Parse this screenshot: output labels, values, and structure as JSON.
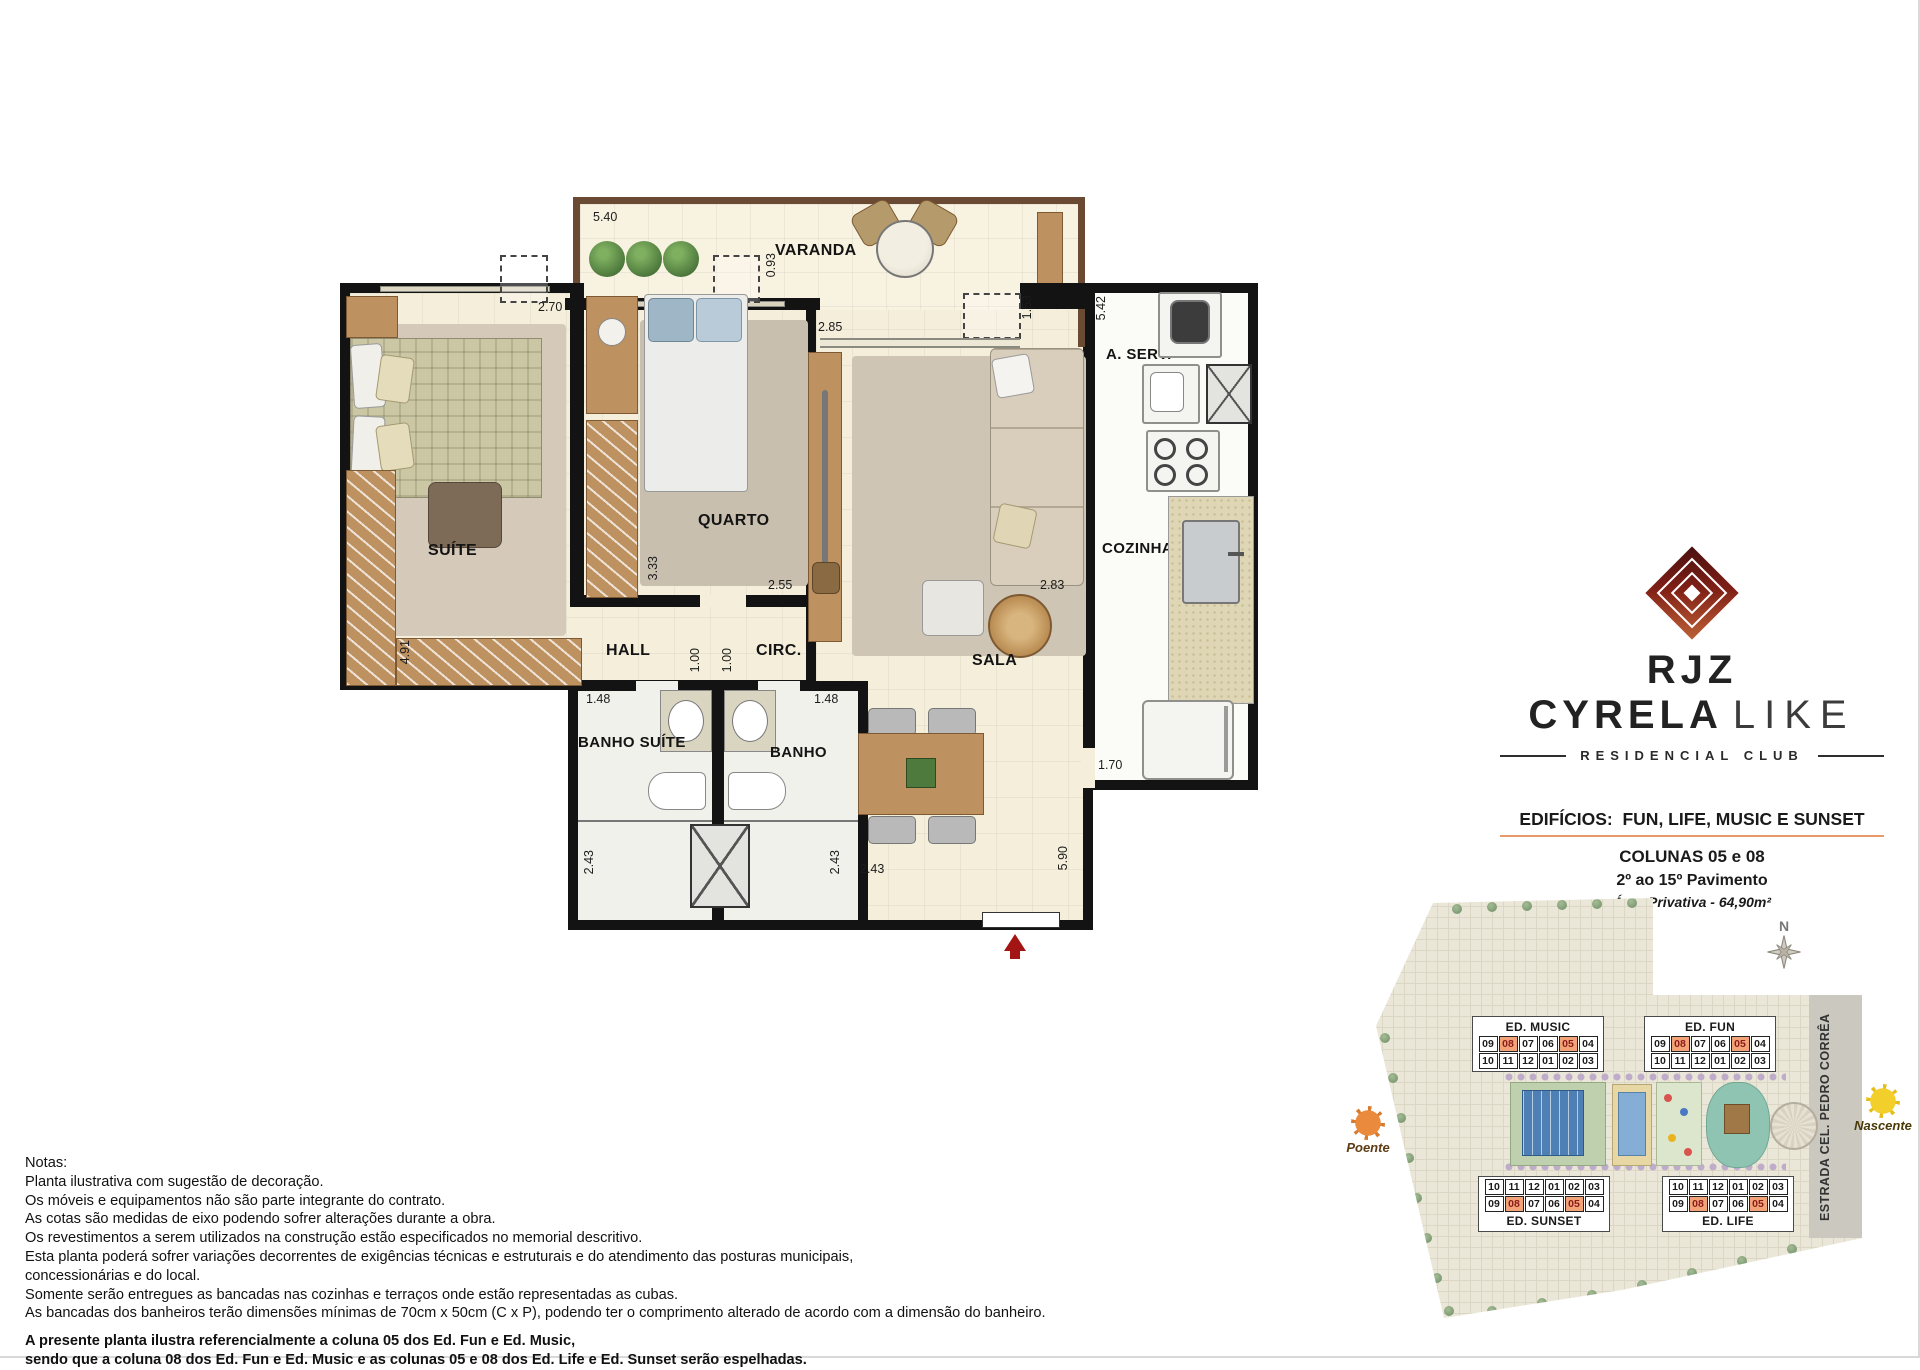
{
  "floorplan": {
    "rooms": {
      "varanda": "VARANDA",
      "suite": "SUÍTE",
      "quarto": "QUARTO",
      "sala": "SALA",
      "cozinha": "COZINHA",
      "area_servico": "A. SERV.",
      "hall": "HALL",
      "circ": "CIRC.",
      "banho_suite": "BANHO SUÍTE",
      "banho": "BANHO"
    },
    "dims": {
      "varanda_width": "5.40",
      "ac_quarto": "0.93",
      "sala_window": "2.85",
      "ac_sala": "1.53",
      "servico_length": "5.42",
      "suite_width": "2.70",
      "quarto_depth": "3.33",
      "quarto_width": "2.55",
      "sala_width": "2.83",
      "banho_suite_width": "1.48",
      "banho_width": "1.48",
      "hall_width": "1.00",
      "circ_width": "1.00",
      "suite_depth": "4.91",
      "banho_suite_depth": "2.43",
      "banho_depth": "2.43",
      "dining_width": "2.43",
      "cozinha_width": "1.70",
      "sala_depth": "5.90"
    }
  },
  "branding": {
    "logo_primary": "RJZ CYRELA",
    "logo_secondary": "LIKE",
    "tagline": "RESIDENCIAL CLUB"
  },
  "info": {
    "edificios": "EDIFÍCIOS:  FUN, LIFE, MUSIC E SUNSET",
    "colunas": "COLUNAS 05 e 08",
    "pavimento": "2º ao 15º Pavimento",
    "area": "Área Privativa - 64,90m²"
  },
  "siteplan": {
    "compass": "N",
    "road": "ESTRADA CEL. PEDRO CORRÊA",
    "sun_west": "Poente",
    "sun_east": "Nascente",
    "highlight": [
      "08",
      "05"
    ],
    "buildings": [
      {
        "name": "ED. MUSIC",
        "rows": [
          [
            "09",
            "08",
            "07",
            "06",
            "05",
            "04"
          ],
          [
            "10",
            "11",
            "12",
            "01",
            "02",
            "03"
          ]
        ]
      },
      {
        "name": "ED. FUN",
        "rows": [
          [
            "09",
            "08",
            "07",
            "06",
            "05",
            "04"
          ],
          [
            "10",
            "11",
            "12",
            "01",
            "02",
            "03"
          ]
        ]
      },
      {
        "name": "ED. SUNSET",
        "rows": [
          [
            "10",
            "11",
            "12",
            "01",
            "02",
            "03"
          ],
          [
            "09",
            "08",
            "07",
            "06",
            "05",
            "04"
          ]
        ]
      },
      {
        "name": "ED. LIFE",
        "rows": [
          [
            "10",
            "11",
            "12",
            "01",
            "02",
            "03"
          ],
          [
            "09",
            "08",
            "07",
            "06",
            "05",
            "04"
          ]
        ]
      }
    ]
  },
  "notes": {
    "heading": "Notas:",
    "lines": [
      "Planta ilustrativa com sugestão de decoração.",
      "Os móveis e equipamentos não são parte integrante do contrato.",
      "As cotas são  medidas  de  eixo podendo sofrer alterações durante a obra.",
      "Os revestimentos a serem utilizados na construção estão especificados no memorial descritivo.",
      "Esta planta poderá sofrer variações decorrentes de exigências técnicas e estruturais e do atendimento das posturas municipais,",
      "concessionárias e do local.",
      "Somente serão entregues as bancadas nas cozinhas e terraços onde estão representadas as cubas.",
      "As bancadas dos banheiros terão dimensões mínimas de 70cm x 50cm (C x P), podendo ter o comprimento alterado de acordo com a dimensão do banheiro."
    ],
    "footer": [
      "A presente planta ilustra referencialmente a coluna 05 dos Ed. Fun e Ed. Music,",
      "sendo que a coluna 08 dos Ed. Fun e Ed. Music e as colunas 05 e 08 dos Ed. Life e Ed. Sunset serão espelhadas."
    ]
  },
  "colors": {
    "accent_orange": "#E89A6B",
    "hl_bg": "#F2A377",
    "hl_text": "#8B1A1A",
    "wall": "#131313",
    "arrow_red": "#A31515",
    "pool_blue": "#4E7FB5",
    "lagoon_teal": "#8FC4B2"
  }
}
